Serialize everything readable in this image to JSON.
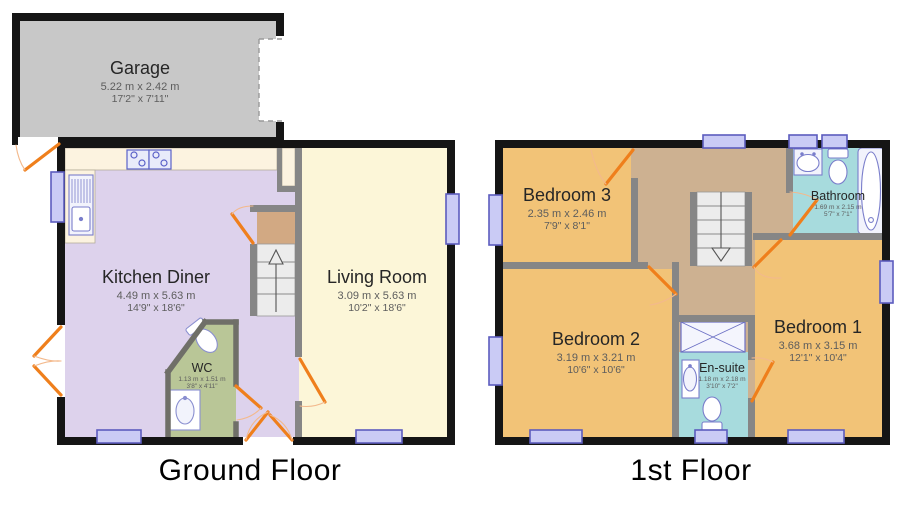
{
  "plan": {
    "floors": [
      {
        "id": "ground",
        "label": "Ground Floor",
        "rooms": [
          {
            "id": "garage",
            "name": "Garage",
            "metric": "5.22 m x 2.42 m",
            "imperial": "17'2\" x 7'11\""
          },
          {
            "id": "kitchen-diner",
            "name": "Kitchen Diner",
            "metric": "4.49 m x 5.63 m",
            "imperial": "14'9\" x 18'6\""
          },
          {
            "id": "living-room",
            "name": "Living Room",
            "metric": "3.09 m x 5.63 m",
            "imperial": "10'2\" x 18'6\""
          },
          {
            "id": "wc",
            "name": "WC",
            "metric": "1.13 m x 1.51 m",
            "imperial": "3'8\" x 4'11\""
          }
        ]
      },
      {
        "id": "first",
        "label": "1st Floor",
        "rooms": [
          {
            "id": "bedroom-3",
            "name": "Bedroom 3",
            "metric": "2.35 m x 2.46 m",
            "imperial": "7'9\" x 8'1\""
          },
          {
            "id": "bathroom",
            "name": "Bathroom",
            "metric": "1.69 m x 2.15 m",
            "imperial": "5'7\" x 7'1\""
          },
          {
            "id": "bedroom-2",
            "name": "Bedroom 2",
            "metric": "3.19 m x 3.21 m",
            "imperial": "10'6\" x 10'6\""
          },
          {
            "id": "en-suite",
            "name": "En-suite",
            "metric": "1.18 m x 2.18 m",
            "imperial": "3'10\" x 7'2\""
          },
          {
            "id": "bedroom-1",
            "name": "Bedroom 1",
            "metric": "3.68 m x 3.15 m",
            "imperial": "12'1\" x 10'4\""
          }
        ]
      }
    ],
    "colors": {
      "wall": "#151515",
      "interior_wall": "#868686",
      "garage_fill": "#c8c8c8",
      "kitchen_fill": "#ddd2ec",
      "living_fill": "#fcf6d8",
      "wc_fill": "#b9c697",
      "counter_fill": "#fcf3e0",
      "bedroom_fill": "#f2c377",
      "landing_fill": "#cdb191",
      "bathroom_fill": "#a7dbdd",
      "stairs_fill": "#ececec",
      "window_fill": "#cacbf5",
      "window_border": "#5c5cbe",
      "door_orange": "#ef7f1c"
    }
  }
}
